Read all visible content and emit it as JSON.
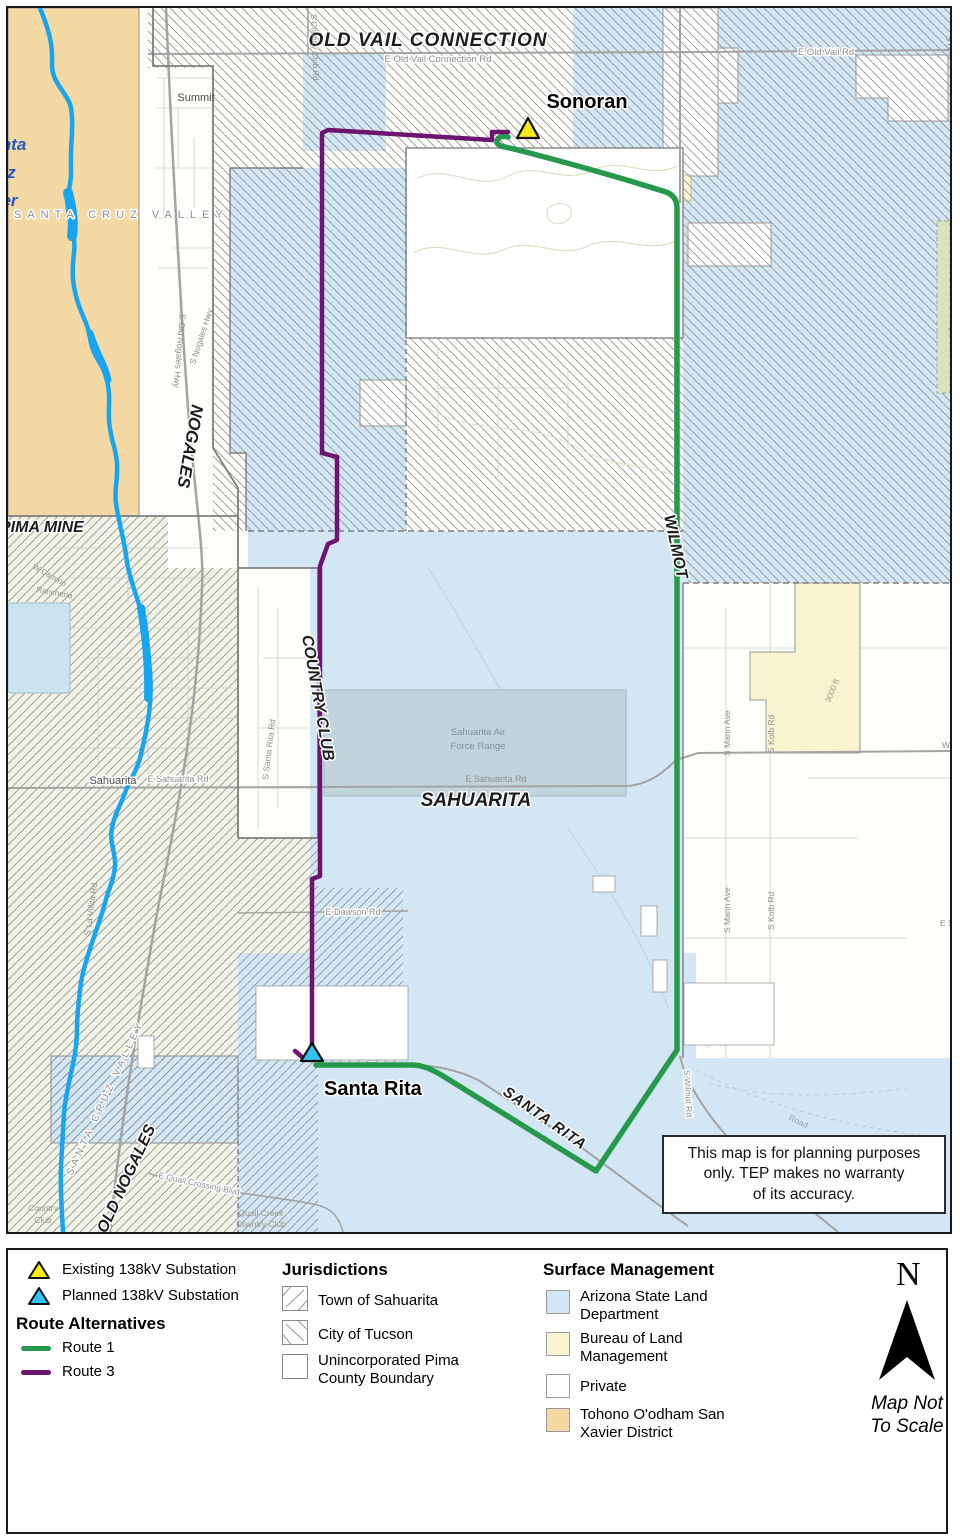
{
  "colors": {
    "route1_green": "#27994d",
    "route3_purple": "#6d1370",
    "state_land_blue": "#d3e6f3",
    "blm_yellow": "#f7f4cf",
    "tohono_orange": "#f5d9a4",
    "private_white": "#ffffff",
    "river_blue": "#18a5f0",
    "existing_sub_yellow": "#f8ec14",
    "planned_sub_cyan": "#2fc4f5"
  },
  "map": {
    "labels": {
      "old_vail_connection": "OLD VAIL CONNECTION",
      "e_old_vail_connection_rd": "E Old Vail Connection Rd",
      "e_old_vail_rd": "E Old Vail Rd",
      "s_country_club_rd": "S Country Club Rd",
      "summit": "Summit",
      "sonoran": "Sonoran",
      "s_rita_rd": "S Rita Rd",
      "elev_3000": "3000 ft",
      "nogales": "NOGALES",
      "santa": "Santa",
      "cruz": "Cruz",
      "river": "River",
      "santa_cruz_valley": "SANTA CRUZ VALLEY",
      "pima_mine": "PIMA MINE",
      "w_camino": "W Camino",
      "rancheria": "Rancheria",
      "s_old_nogales_hwy": "S Old Nogales Hwy",
      "s_nogales_hwy": "S Nogales Hwy",
      "sahuarita_town": "Sahuarita",
      "e_sahuarita_rd": "E Sahuarita Rd",
      "country_club": "COUNTRY CLUB",
      "wilmot": "WILMOT",
      "sahuarita": "SAHUARITA",
      "af_range_line1": "Sahuarita Air",
      "af_range_line2": "Force Range",
      "s_santa_rita_rd": "S Santa Rita Rd",
      "e_dawson_rd": "E Dawson Rd",
      "s_mann_ave": "S Mann Ave",
      "s_kolb_rd": "S Kolb Rd",
      "old_nogales": "OLD NOGALES",
      "s_la_villita_rd": "S La Villita Rd",
      "e_quail_crossing_blvd": "E Quail Crossing Blvd",
      "quail_creek_line1": "Quail Creek",
      "quail_creek_line2": "Country Club",
      "country_line1": "Country",
      "country_line2": "Club",
      "santa_rita": "Santa Rita",
      "santa_rita_road": "SANTA RITA",
      "s_wilmot_rd": "S Wilmot Rd",
      "road": "Road",
      "e_s": "E S",
      "w": "W"
    },
    "disclaimer": {
      "line1": "This map is for planning purposes",
      "line2": "only. TEP makes no warranty",
      "line3": "of its accuracy."
    }
  },
  "legend": {
    "substations": [
      {
        "label": "Existing 138kV Substation"
      },
      {
        "label": "Planned 138kV Substation"
      }
    ],
    "routes": {
      "title": "Route Alternatives",
      "items": [
        {
          "label": "Route 1"
        },
        {
          "label": "Route 3"
        }
      ]
    },
    "jurisdictions": {
      "title": "Jurisdictions",
      "items": [
        {
          "label": "Town of Sahuarita"
        },
        {
          "label": "City of Tucson"
        },
        {
          "label": "Unincorporated Pima County Boundary"
        }
      ]
    },
    "surface": {
      "title": "Surface Management",
      "items": [
        {
          "label": "Arizona State Land Department"
        },
        {
          "label": "Bureau of Land Management"
        },
        {
          "label": "Private"
        },
        {
          "label": "Tohono O'odham San Xavier District"
        }
      ]
    },
    "north": {
      "letter": "N",
      "note1": "Map Not",
      "note2": "To Scale"
    }
  }
}
